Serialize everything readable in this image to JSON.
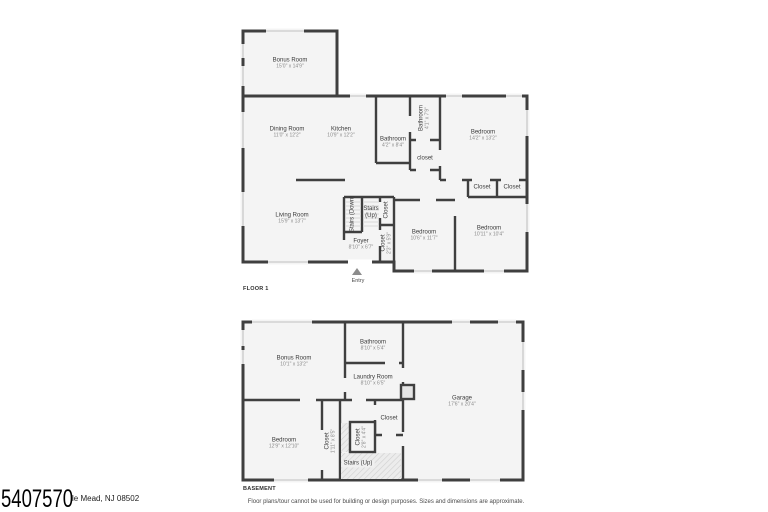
{
  "colors": {
    "wall": "#3f3f3f",
    "room_fill": "#f4f4f4",
    "window": "#c9c9c9"
  },
  "listing": {
    "id": "5407570",
    "address_visible": "le Mead, NJ 08502"
  },
  "footer": {
    "disclaimer": "Floor plans/tour cannot be used for building or design purposes. Sizes and dimensions are approximate."
  },
  "floor1": {
    "caption": "FLOOR 1",
    "entry_label": "Entry",
    "rooms": [
      {
        "name": "Bonus Room",
        "dims": "15'0\" x 14'9\""
      },
      {
        "name": "Dining Room",
        "dims": "11'0\" x 12'2\""
      },
      {
        "name": "Kitchen",
        "dims": "10'9\" x 12'2\""
      },
      {
        "name": "Bathroom",
        "dims": "4'2\" x 8'4\""
      },
      {
        "name": "Bathroom",
        "dims": "4'1\" x 7'9\""
      },
      {
        "name": "Bedroom",
        "dims": "14'2\" x 13'2\""
      },
      {
        "name": "closet",
        "dims": ""
      },
      {
        "name": "Closet",
        "dims": ""
      },
      {
        "name": "Closet",
        "dims": ""
      },
      {
        "name": "Living Room",
        "dims": "15'9\" x 13'7\""
      },
      {
        "name": "Stairs (Down)",
        "dims": ""
      },
      {
        "name": "Stairs (Up)",
        "dims": ""
      },
      {
        "name": "Closet",
        "dims": ""
      },
      {
        "name": "Foyer",
        "dims": "8'10\" x 6'7\""
      },
      {
        "name": "Closet",
        "dims": "2'3\" x 5'9\""
      },
      {
        "name": "Bedroom",
        "dims": "10'6\" x 11'7\""
      },
      {
        "name": "Bedroom",
        "dims": "10'11\" x 10'4\""
      }
    ]
  },
  "basement": {
    "caption": "BASEMENT",
    "rooms": [
      {
        "name": "Bonus Room",
        "dims": "10'1\" x 13'2\""
      },
      {
        "name": "Bathroom",
        "dims": "8'10\" x 5'4\""
      },
      {
        "name": "Laundry Room",
        "dims": "8'10\" x 6'5\""
      },
      {
        "name": "Garage",
        "dims": "17'6\" x 20'4\""
      },
      {
        "name": "Bedroom",
        "dims": "12'9\" x 12'10\""
      },
      {
        "name": "Closet",
        "dims": "1'11\" x 8'5\""
      },
      {
        "name": "Closet",
        "dims": ""
      },
      {
        "name": "Closet",
        "dims": "2'8\" x 4'4\""
      },
      {
        "name": "Stairs (Up)",
        "dims": ""
      }
    ]
  }
}
